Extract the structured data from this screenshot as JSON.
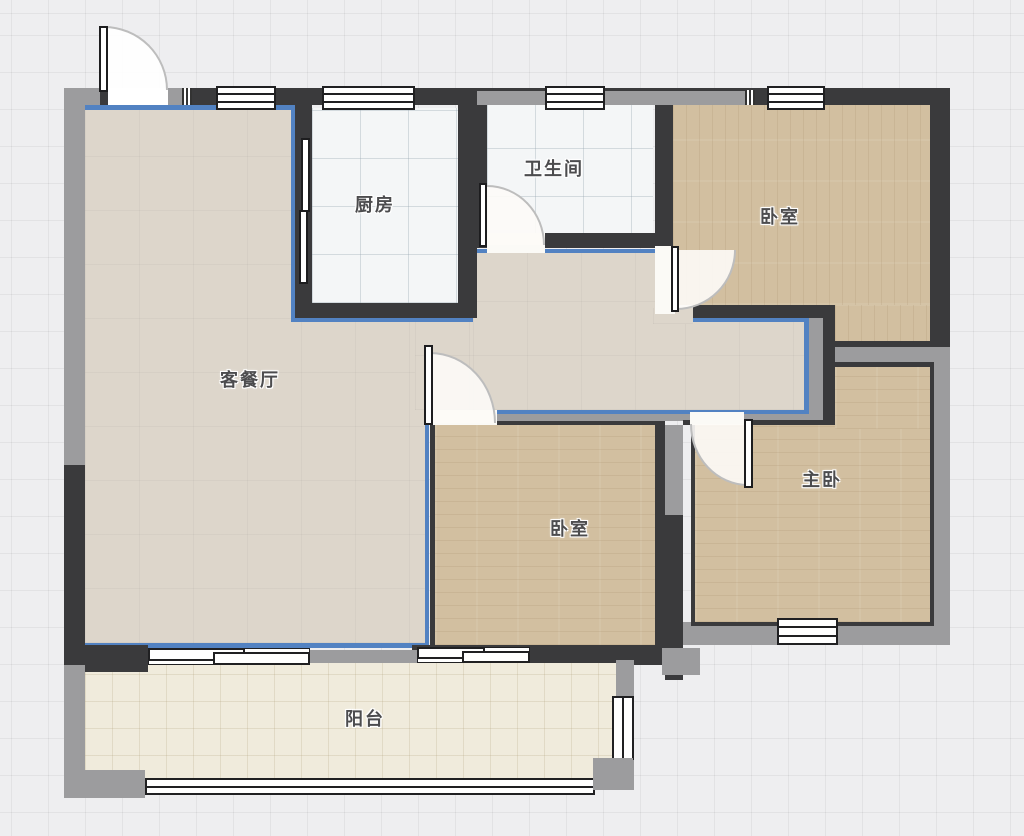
{
  "rooms": {
    "kitchen": {
      "label": "厨房"
    },
    "bathroom": {
      "label": "卫生间"
    },
    "bedroom_top": {
      "label": "卧室"
    },
    "living_dining": {
      "label": "客餐厅"
    },
    "bedroom_mid": {
      "label": "卧室"
    },
    "master_bedroom": {
      "label": "主卧"
    },
    "balcony": {
      "label": "阳台"
    }
  },
  "colors": {
    "bg": "#eeeef0",
    "wall-dark": "#3a3a3c",
    "wall-gray": "#9c9c9e",
    "outline-blue": "#5282c2",
    "floor-living": "#ddd6cb",
    "floor-tile": "#f4f6f7",
    "floor-wood": "#d2bfa0",
    "floor-balcony": "#f0ebdc",
    "label": "#4c4c4e"
  }
}
